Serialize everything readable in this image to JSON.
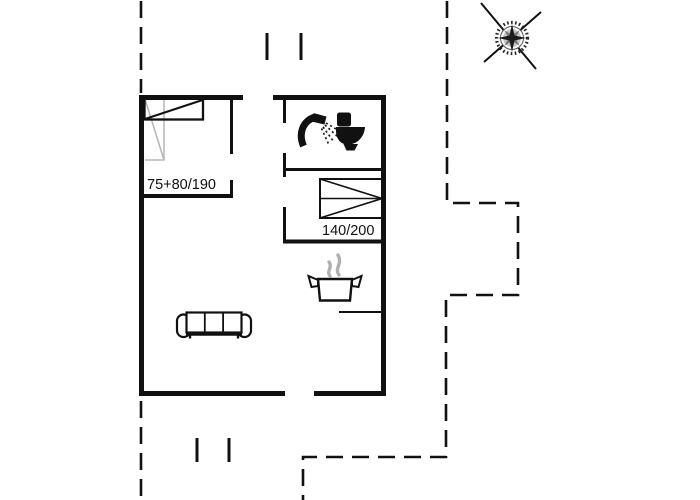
{
  "floorplan": {
    "bedroom1": {
      "bed_label": "75+80/190"
    },
    "bedroom2": {
      "bed_label": "140/200"
    },
    "icons": {
      "compass": "compass-rose-icon",
      "shower": "shower-icon",
      "toilet": "toilet-icon",
      "stove": "steaming-pot-icon",
      "sofa": "sofa-icon",
      "bed_small": "bed-single-icon",
      "bed_large": "bed-double-icon"
    },
    "colors": {
      "wall": "#111111",
      "boundary": "#111111",
      "background": "#ffffff",
      "light_furniture": "#b5b5b5",
      "steam": "#b0b0b0"
    }
  }
}
